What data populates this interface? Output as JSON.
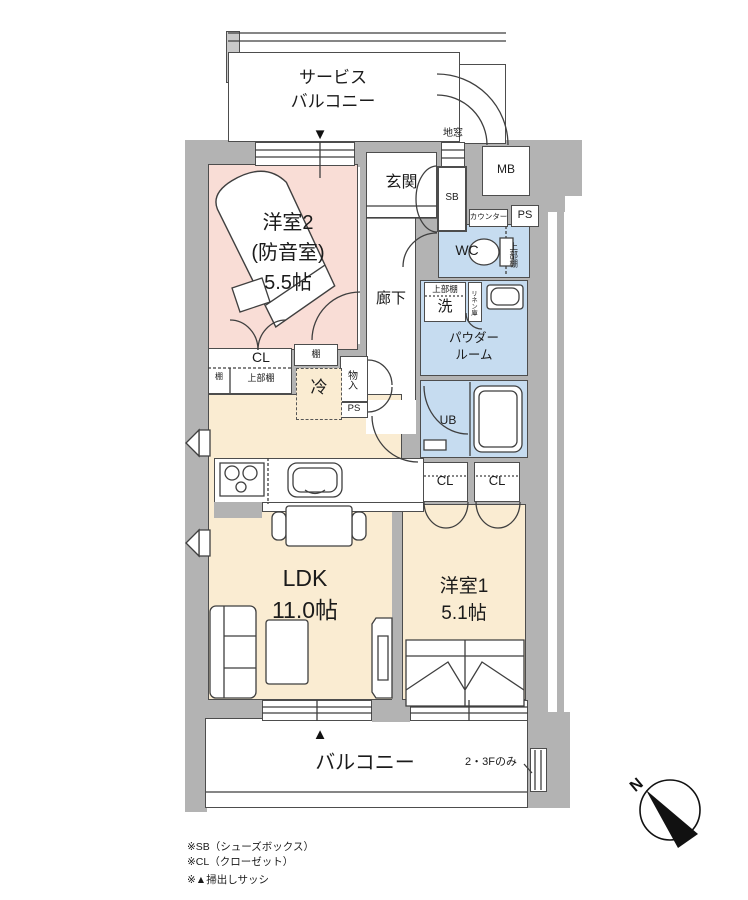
{
  "colors": {
    "wall": "#b3b3b3",
    "room_pink": "#f9ddd6",
    "room_cream": "#faecd2",
    "room_blue": "#c6dcf0",
    "line": "#4d4d4d",
    "marker_black": "#111111"
  },
  "rooms": {
    "service_balcony": {
      "line1": "サービス",
      "line2": "バルコニー"
    },
    "genkan": "玄関",
    "western2": {
      "line1": "洋室2",
      "line2": "(防音室)",
      "line3": "5.5帖"
    },
    "corridor": "廊下",
    "wc": "WC",
    "powder": {
      "line1": "パウダー",
      "line2": "ルーム"
    },
    "bath": "UB",
    "ldk": {
      "line1": "LDK",
      "line2": "11.0帖"
    },
    "western1": {
      "line1": "洋室1",
      "line2": "5.1帖"
    },
    "balcony": "バルコニー"
  },
  "fixtures": {
    "shoe_box": "SB",
    "meter_box": "MB",
    "pipe_space_top": "PS",
    "pipe_space_mid": "PS",
    "counter": "カウンター",
    "floor_window": "地窓",
    "closet_w2": "CL",
    "shelf_small": "棚",
    "upper_shelf_w2": "上部棚",
    "shelf_mid": "棚",
    "fridge": "冷",
    "storage": "物入",
    "washer": "洗",
    "upper_shelf_washer": "上部棚",
    "linen": "リネン庫",
    "upper_shelf_wc": "上部棚",
    "closet1": "CL",
    "closet2": "CL",
    "floors_note": "2・3Fのみ"
  },
  "markers": {
    "window_marker_down": "▼",
    "window_marker_up": "▲",
    "north": "N"
  },
  "notes": [
    "※SB（シューズボックス）",
    "※CL（クローゼット）",
    "※▲掃出しサッシ"
  ]
}
